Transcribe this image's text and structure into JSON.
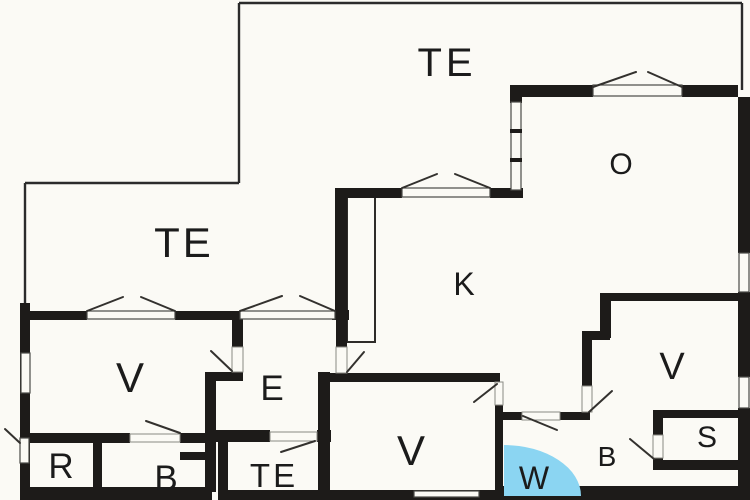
{
  "plan": {
    "type": "floor-plan",
    "colors": {
      "background": "#FBFAF5",
      "wall": "#1D1B19",
      "terrace_line": "#2B2B2B",
      "shower_area": "#8BD5F2",
      "label_text": "#1B1B1B"
    },
    "rooms": [
      {
        "id": "terrace-top",
        "label": "TE"
      },
      {
        "id": "terrace-left",
        "label": "TE"
      },
      {
        "id": "room-o",
        "label": "O"
      },
      {
        "id": "room-k",
        "label": "K"
      },
      {
        "id": "room-v-left",
        "label": "V"
      },
      {
        "id": "room-v-right",
        "label": "V"
      },
      {
        "id": "room-v-bottom",
        "label": "V"
      },
      {
        "id": "room-e",
        "label": "E"
      },
      {
        "id": "room-r",
        "label": "R"
      },
      {
        "id": "room-b-left",
        "label": "B"
      },
      {
        "id": "terrace-bottom",
        "label": "TE"
      },
      {
        "id": "room-w",
        "label": "W"
      },
      {
        "id": "room-b-right",
        "label": "B"
      },
      {
        "id": "room-s",
        "label": "S"
      }
    ]
  }
}
